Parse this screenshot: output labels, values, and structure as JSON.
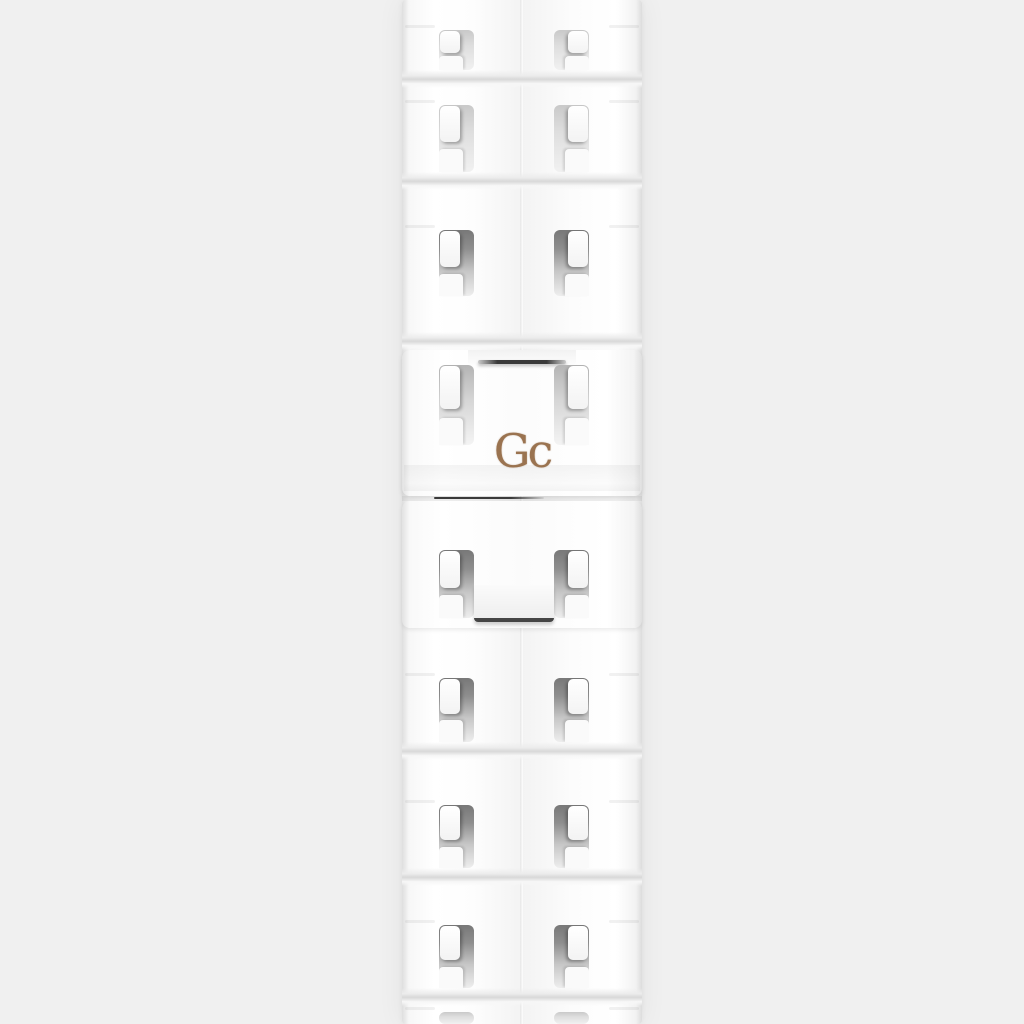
{
  "scene": {
    "type": "product-photo",
    "background_color": "#f0f0f0"
  },
  "product": {
    "name": "white-ceramic-link-watch-bracelet",
    "ceramic_color": "#ffffff",
    "slot_shadow_color": "#787878",
    "clasp_line_color": "#3a3a3a"
  },
  "brand": {
    "logo_text": "Gc",
    "logo_color": "#9a7350"
  }
}
